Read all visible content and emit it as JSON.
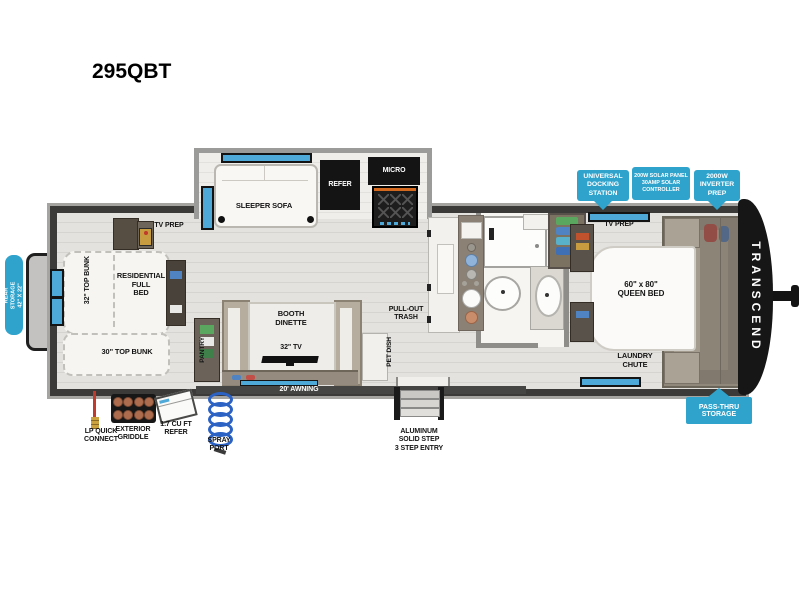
{
  "page": {
    "title": "295QBT",
    "background": "#ffffff"
  },
  "plan": {
    "brand": "TRANSCEND",
    "model": "295QBT"
  },
  "colors": {
    "badge_blue": "#2fa3cc",
    "window_blue": "#4fa9d8",
    "wall_dark": "#3b3a38",
    "wall_light": "#a5a4a1",
    "floor": "#e3e2de"
  },
  "badges": {
    "docking": "UNIVERSAL\nDOCKING\nSTATION",
    "solar": "200W SOLAR PANEL\n30AMP SOLAR\nCONTROLLER",
    "inverter": "2000W\nINVERTER\nPREP",
    "rear_storage": "REAR STORAGE\n42\" X 22\"",
    "pass_thru": "PASS-THRU\nSTORAGE"
  },
  "rooms": {
    "tv_prep_left": "TV PREP",
    "bunk32": "32\" TOP BUNK",
    "full_bed": "RESIDENTIAL\nFULL\nBED",
    "bunk30": "30\" TOP BUNK",
    "pantry": "PANTRY",
    "sleeper_sofa": "SLEEPER SOFA",
    "refer": "REFER",
    "micro": "MICRO",
    "booth_dinette": "BOOTH\nDINETTE",
    "tv32": "32\" TV",
    "pull_out_trash": "PULL-OUT\nTRASH",
    "pet_dish": "PET DISH",
    "tv_prep_right": "TV PREP",
    "queen_bed": "60\" x 80\"\nQUEEN BED",
    "laundry_chute": "LAUNDRY\nCHUTE",
    "awning": "20' AWNING"
  },
  "callouts": {
    "lp": "LP QUICK\nCONNECT",
    "griddle": "EXTERIOR\nGRIDDLE",
    "mini_refer": "1.7 CU FT\nREFER",
    "spray": "SPRAY\nPORT",
    "steps": "ALUMINUM\nSOLID STEP\n3 STEP ENTRY"
  }
}
